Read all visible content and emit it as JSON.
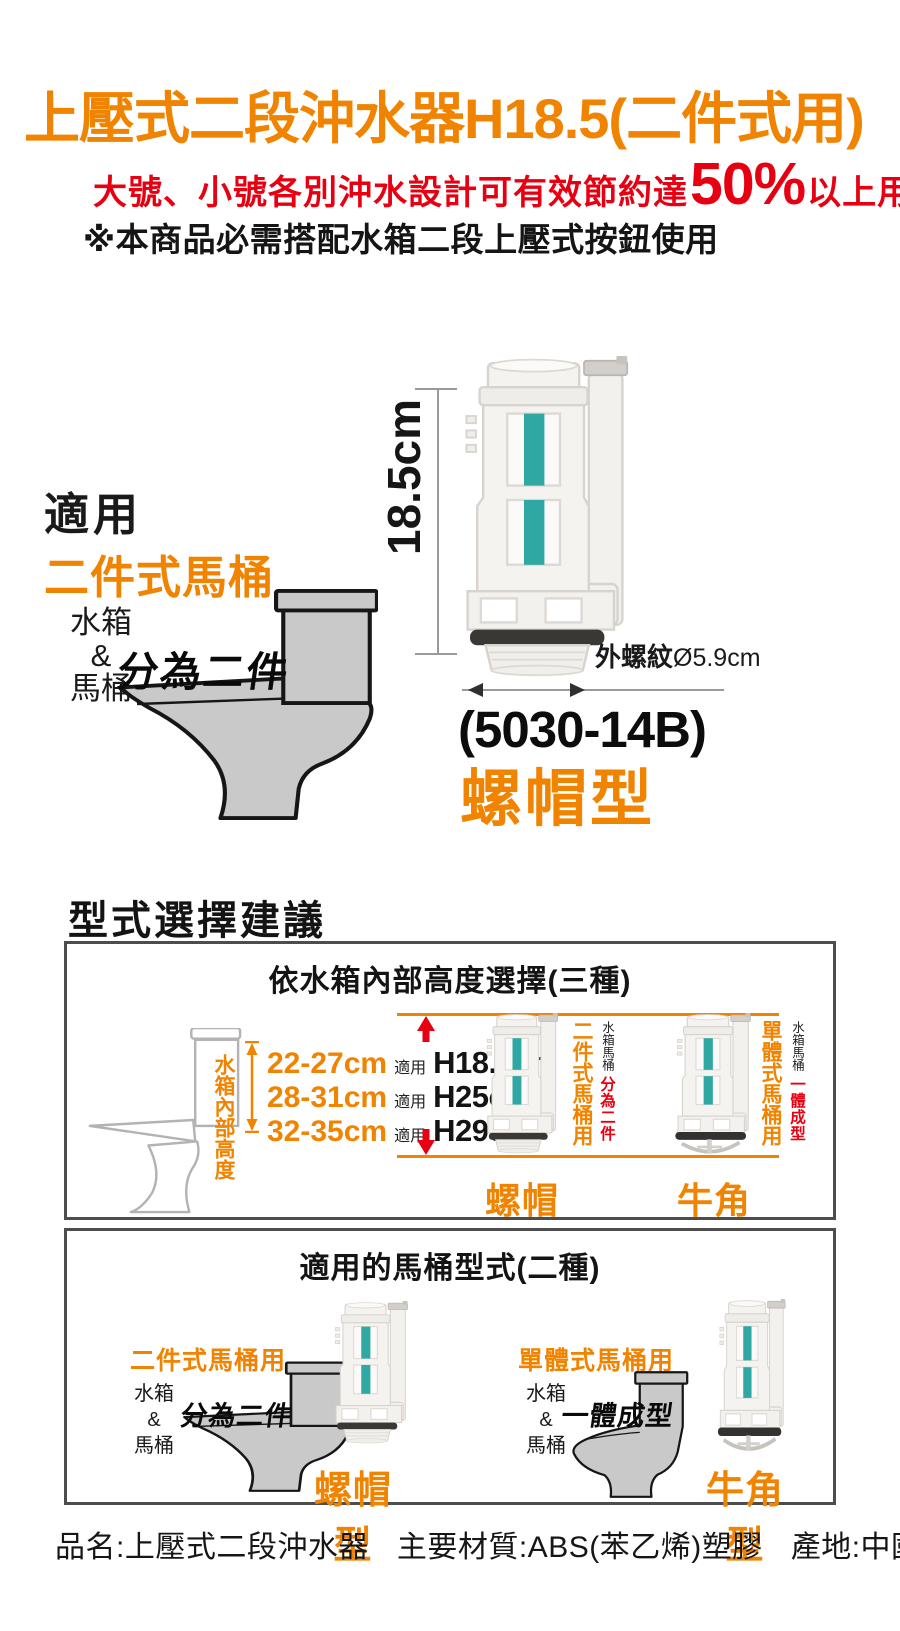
{
  "colors": {
    "orange": "#f08300",
    "red": "#e60012",
    "teal": "#2fa7a3",
    "toilet_gray": "#c9c9c9",
    "outline_gray": "#b3b3b3",
    "dim_gray": "#9a9a9a"
  },
  "header": {
    "title": "上壓式二段沖水器H18.5(二件式用)",
    "benefit_pre": "大號、小號各別沖水設計可有效節約達",
    "benefit_pct": "50%",
    "benefit_post": "以上用水",
    "note": "※本商品必需搭配水箱二段上壓式按鈕使用"
  },
  "hero": {
    "dim_label": "18.5cm",
    "fit_title": "適用",
    "fit_type": "二件式馬桶",
    "tank": "水箱",
    "amp": "&",
    "bowl": "馬桶",
    "split": "分為二件",
    "thread": "外螺紋",
    "thread_dim": "Ø5.9cm",
    "model": "(5030-14B)",
    "type": "螺帽型"
  },
  "advice": {
    "heading": "型式選擇建議",
    "box1": {
      "title": "依水箱內部高度選擇(三種)",
      "tank_height_label": "水箱內部高度",
      "rows": [
        {
          "range": "22-27cm",
          "fit": "適用",
          "valve": "H18.5cm"
        },
        {
          "range": "28-31cm",
          "fit": "適用",
          "valve": "H25cm"
        },
        {
          "range": "32-35cm",
          "fit": "適用",
          "valve": "H29cm"
        }
      ],
      "left": {
        "main": "二件式馬桶用",
        "sub": "水箱馬桶",
        "accent": "分為二件",
        "type": "螺帽型"
      },
      "right": {
        "main": "單體式馬桶用",
        "sub": "水箱馬桶",
        "accent": "一體成型",
        "type": "牛角型"
      }
    },
    "box2": {
      "title": "適用的馬桶型式(二種)",
      "left": {
        "heading": "二件式馬桶用",
        "tank": "水箱",
        "amp": "&",
        "bowl": "馬桶",
        "joined": "分為二件",
        "type": "螺帽型"
      },
      "right": {
        "heading": "單體式馬桶用",
        "tank": "水箱",
        "amp": "&",
        "bowl": "馬桶",
        "joined": "一體成型",
        "type": "牛角型"
      }
    }
  },
  "footer": {
    "name": "品名:上壓式二段沖水器",
    "material": "主要材質:ABS(苯乙烯)塑膠",
    "origin": "產地:中國"
  }
}
